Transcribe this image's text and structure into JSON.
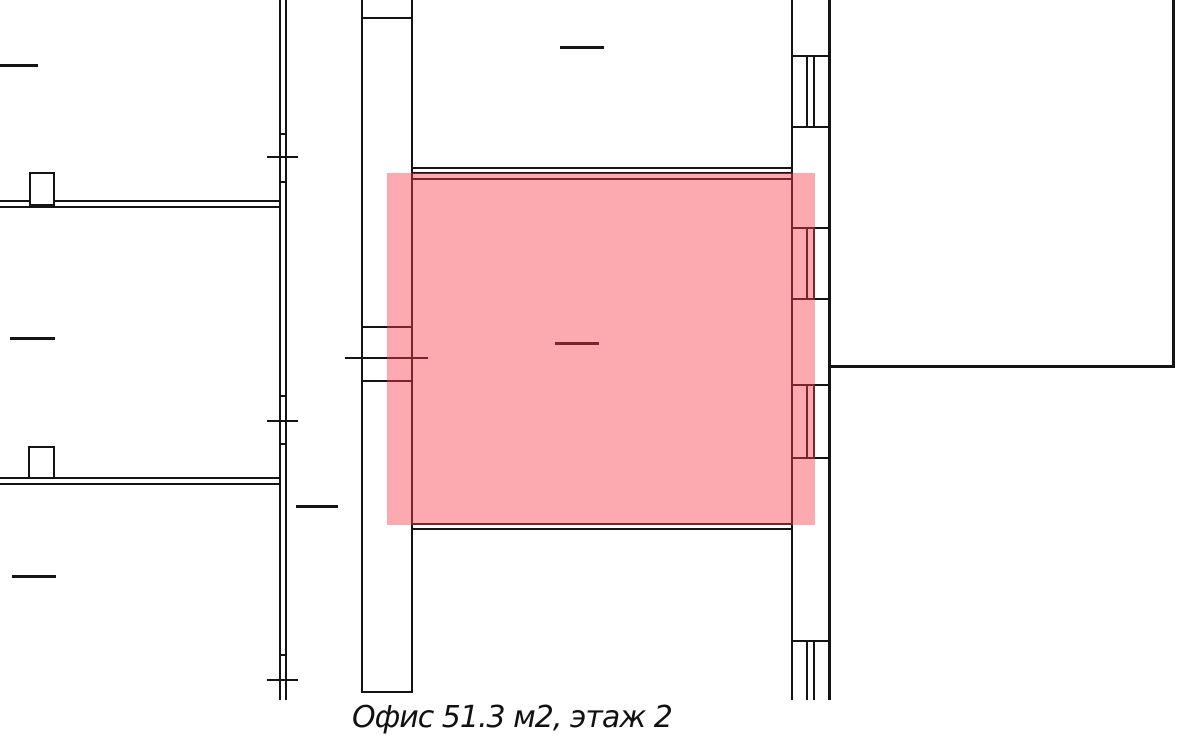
{
  "floorplan": {
    "canvas": {
      "width": 1200,
      "height": 745,
      "background": "#ffffff",
      "line_color": "#141414"
    },
    "caption": {
      "text": "Офис 51.3 м2, этаж 2",
      "area_m2": "51.3",
      "floor": "2"
    },
    "highlight": {
      "name": "highlighted-office-room",
      "x": 387,
      "y": 173,
      "w": 428,
      "h": 352,
      "color": "#F83C48",
      "opacity": 0.44
    },
    "walls": [
      {
        "name": "left-outer-wall-line-a",
        "x": 279,
        "y": 0,
        "w": 2,
        "h": 700
      },
      {
        "name": "left-outer-wall-line-b",
        "x": 285,
        "y": 0,
        "w": 2,
        "h": 700
      },
      {
        "name": "left-wall-notch",
        "x": 279,
        "y": 133,
        "w": 8,
        "h": 2
      },
      {
        "name": "left-wall-notch",
        "x": 279,
        "y": 181,
        "w": 8,
        "h": 2
      },
      {
        "name": "left-wall-notch",
        "x": 279,
        "y": 395,
        "w": 8,
        "h": 2
      },
      {
        "name": "left-wall-notch",
        "x": 279,
        "y": 443,
        "w": 8,
        "h": 2
      },
      {
        "name": "left-wall-notch",
        "x": 279,
        "y": 654,
        "w": 8,
        "h": 2
      },
      {
        "name": "left-wall-tick",
        "x": 267,
        "y": 156,
        "w": 31,
        "h": 2
      },
      {
        "name": "left-wall-tick",
        "x": 267,
        "y": 420,
        "w": 31,
        "h": 2
      },
      {
        "name": "left-wall-tick",
        "x": 267,
        "y": 679,
        "w": 31,
        "h": 2
      },
      {
        "name": "left-room-divider-line-a",
        "x": 0,
        "y": 200,
        "w": 281,
        "h": 2
      },
      {
        "name": "left-room-divider-line-b",
        "x": 0,
        "y": 206,
        "w": 281,
        "h": 2
      },
      {
        "name": "left-room-divider2-line-a",
        "x": 0,
        "y": 477,
        "w": 281,
        "h": 2
      },
      {
        "name": "left-room-divider2-line-b",
        "x": 0,
        "y": 483,
        "w": 281,
        "h": 2
      },
      {
        "name": "corridor-wall-left",
        "x": 361,
        "y": 0,
        "w": 2,
        "h": 693
      },
      {
        "name": "corridor-wall-right",
        "x": 411,
        "y": 0,
        "w": 2,
        "h": 693
      },
      {
        "name": "corridor-top-cap",
        "x": 361,
        "y": 17,
        "w": 52,
        "h": 2
      },
      {
        "name": "corridor-bottom-cap",
        "x": 361,
        "y": 691,
        "w": 52,
        "h": 2
      },
      {
        "name": "corridor-door-line",
        "x": 361,
        "y": 326,
        "w": 52,
        "h": 2
      },
      {
        "name": "corridor-door-line",
        "x": 361,
        "y": 380,
        "w": 52,
        "h": 2
      },
      {
        "name": "corridor-door-tick",
        "x": 345,
        "y": 357,
        "w": 83,
        "h": 2
      },
      {
        "name": "upper-room-floor-line-a",
        "x": 411,
        "y": 167,
        "w": 382,
        "h": 2
      },
      {
        "name": "upper-room-floor-line-b",
        "x": 411,
        "y": 172,
        "w": 382,
        "h": 2
      },
      {
        "name": "office-top-wall",
        "x": 411,
        "y": 178,
        "w": 382,
        "h": 2
      },
      {
        "name": "office-left-wall",
        "x": 411,
        "y": 178,
        "w": 2,
        "h": 347
      },
      {
        "name": "office-bottom-wall",
        "x": 411,
        "y": 523,
        "w": 382,
        "h": 2
      },
      {
        "name": "office-bottom-wall-outer",
        "x": 411,
        "y": 528,
        "w": 382,
        "h": 2
      },
      {
        "name": "right-wall-inner",
        "x": 791,
        "y": 0,
        "w": 2,
        "h": 700
      },
      {
        "name": "right-wall-outer",
        "x": 828,
        "y": 0,
        "w": 3,
        "h": 700
      },
      {
        "name": "window-cap",
        "x": 791,
        "y": 55,
        "w": 40,
        "h": 2
      },
      {
        "name": "window-cap",
        "x": 791,
        "y": 126,
        "w": 40,
        "h": 2
      },
      {
        "name": "window-cap",
        "x": 791,
        "y": 227,
        "w": 40,
        "h": 2
      },
      {
        "name": "window-cap",
        "x": 791,
        "y": 298,
        "w": 40,
        "h": 2
      },
      {
        "name": "window-cap",
        "x": 791,
        "y": 384,
        "w": 40,
        "h": 2
      },
      {
        "name": "window-cap",
        "x": 791,
        "y": 457,
        "w": 40,
        "h": 2
      },
      {
        "name": "window-cap",
        "x": 791,
        "y": 640,
        "w": 40,
        "h": 2
      },
      {
        "name": "window-frame-line",
        "x": 806,
        "y": 55,
        "w": 2,
        "h": 73
      },
      {
        "name": "window-frame-line",
        "x": 813,
        "y": 55,
        "w": 2,
        "h": 73
      },
      {
        "name": "window-frame-line",
        "x": 806,
        "y": 227,
        "w": 2,
        "h": 73
      },
      {
        "name": "window-frame-line",
        "x": 813,
        "y": 227,
        "w": 2,
        "h": 73
      },
      {
        "name": "window-frame-line",
        "x": 806,
        "y": 384,
        "w": 2,
        "h": 75
      },
      {
        "name": "window-frame-line",
        "x": 813,
        "y": 384,
        "w": 2,
        "h": 75
      },
      {
        "name": "window-frame-line",
        "x": 806,
        "y": 640,
        "w": 2,
        "h": 60
      },
      {
        "name": "window-frame-line",
        "x": 813,
        "y": 640,
        "w": 2,
        "h": 60
      },
      {
        "name": "right-room-bottom-wall",
        "x": 828,
        "y": 365,
        "w": 347,
        "h": 3
      },
      {
        "name": "right-room-right-wall",
        "x": 1172,
        "y": 0,
        "w": 3,
        "h": 368
      }
    ],
    "pillars": [
      {
        "name": "wall-pillar",
        "x": 29,
        "y": 172,
        "w": 26,
        "h": 34
      },
      {
        "name": "wall-pillar",
        "x": 28,
        "y": 446,
        "w": 27,
        "h": 33
      }
    ],
    "dashes": [
      {
        "name": "room-label-dash",
        "x": 0,
        "y": 64,
        "w": 38,
        "h": 3
      },
      {
        "name": "room-label-dash",
        "x": 10,
        "y": 337,
        "w": 45,
        "h": 3
      },
      {
        "name": "room-label-dash",
        "x": 12,
        "y": 575,
        "w": 44,
        "h": 3
      },
      {
        "name": "room-label-dash",
        "x": 296,
        "y": 505,
        "w": 42,
        "h": 3
      },
      {
        "name": "room-label-dash",
        "x": 560,
        "y": 46,
        "w": 44,
        "h": 3
      },
      {
        "name": "office-label-dash",
        "x": 555,
        "y": 342,
        "w": 44,
        "h": 3
      }
    ]
  }
}
